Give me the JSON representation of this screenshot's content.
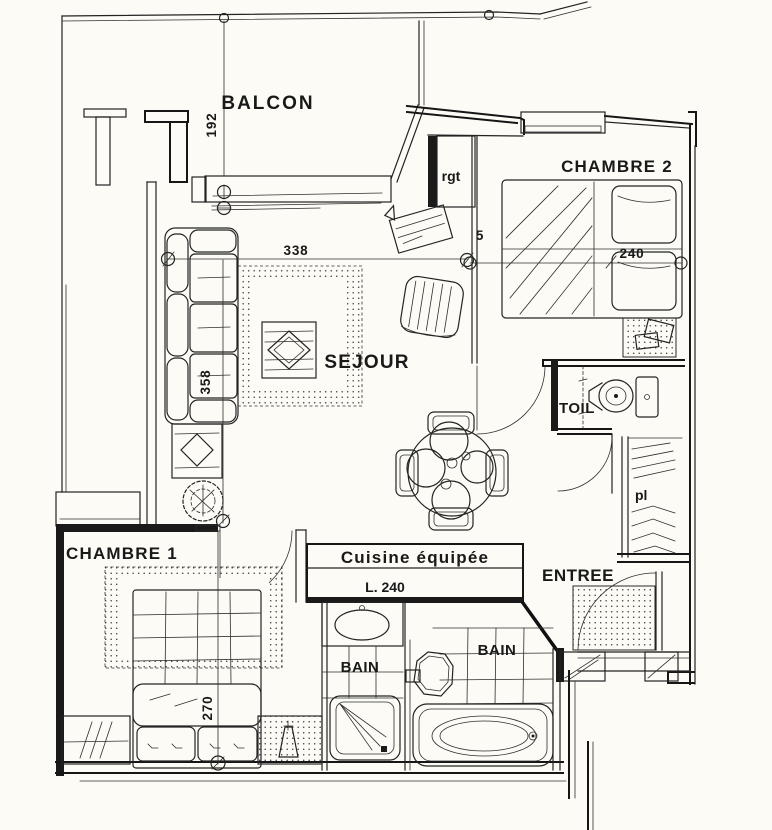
{
  "colors": {
    "paper": "#fcfbf5",
    "ink": "#1a1a1a"
  },
  "rooms": {
    "balcon": {
      "label": "BALCON"
    },
    "chambre2": {
      "label": "CHAMBRE 2"
    },
    "rgt": {
      "label": "rgt"
    },
    "sejour": {
      "label": "SEJOUR"
    },
    "toil": {
      "label": "TOIL"
    },
    "pl": {
      "label": "pl"
    },
    "chambre1": {
      "label": "CHAMBRE 1"
    },
    "cuisine": {
      "label": "Cuisine équipée",
      "length": "L. 240"
    },
    "entree": {
      "label": "ENTREE"
    },
    "bain_left": {
      "label": "BAIN"
    },
    "bain_right": {
      "label": "BAIN"
    }
  },
  "dimensions": {
    "balcon_depth": "192",
    "sejour_width": "338",
    "sejour_depth": "358",
    "chambre2_width": "240",
    "wall_gap": "5",
    "chambre1_depth": "270"
  }
}
